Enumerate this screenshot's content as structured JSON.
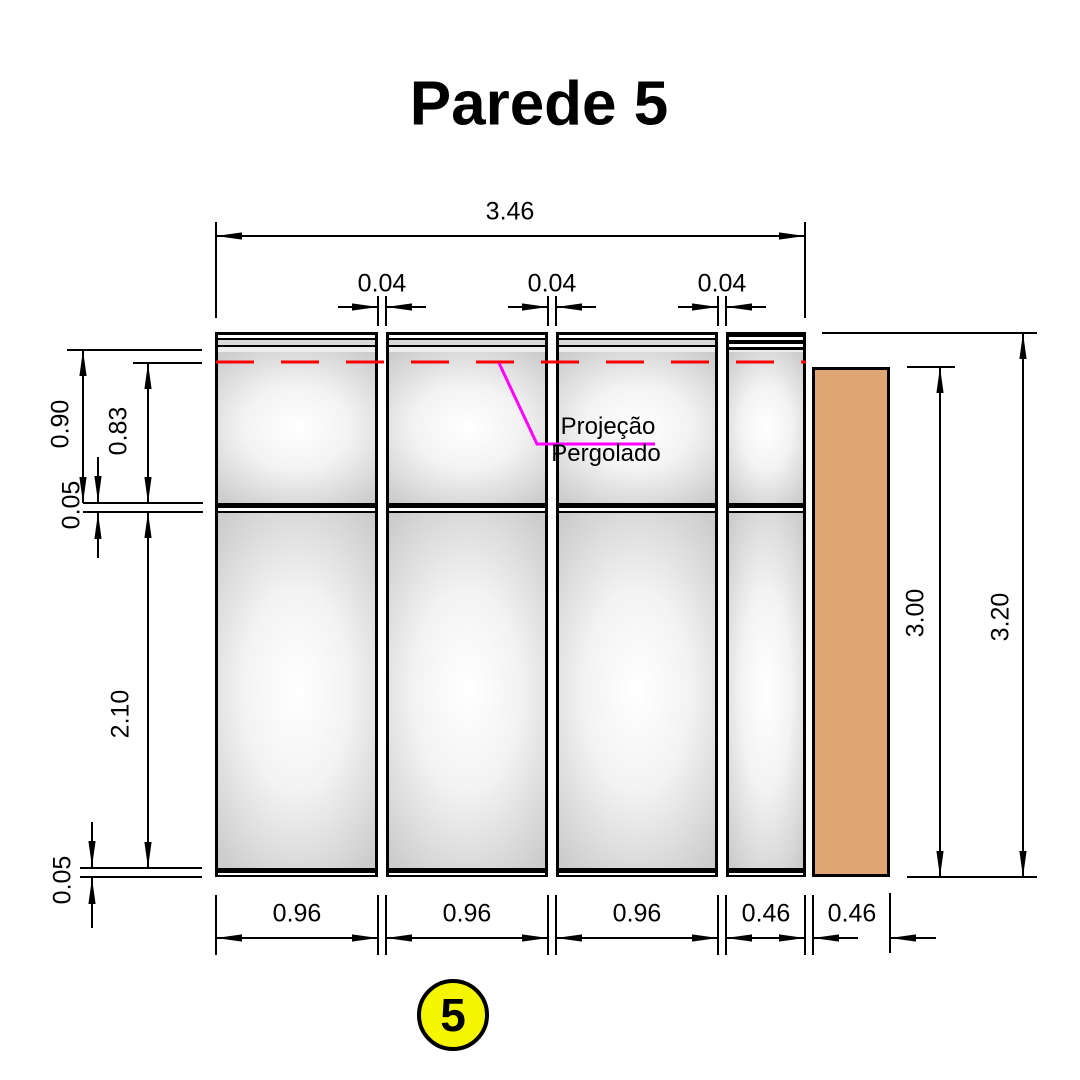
{
  "title": "Parede 5",
  "wall_badge": {
    "number": "5"
  },
  "callout": {
    "line1": "Projeção",
    "line2": "Pergolado"
  },
  "dims": {
    "total_width": "3.46",
    "top_gaps": [
      "0.04",
      "0.04",
      "0.04"
    ],
    "left_outer": "0.90",
    "left_inner": "0.83",
    "left_gap_upper": "0.05",
    "left_lower": "2.10",
    "left_gap_lower": "0.05",
    "right_inner": "3.00",
    "right_outer": "3.20",
    "bottom_widths": [
      "0.96",
      "0.96",
      "0.96",
      "0.46",
      "0.46"
    ]
  },
  "colors": {
    "projection_leader": "#FF00FF",
    "projection_dashed_line": "#FF0000",
    "column_fill": "#DFA572",
    "badge_fill": "#F6F600",
    "line_color": "#000000"
  }
}
